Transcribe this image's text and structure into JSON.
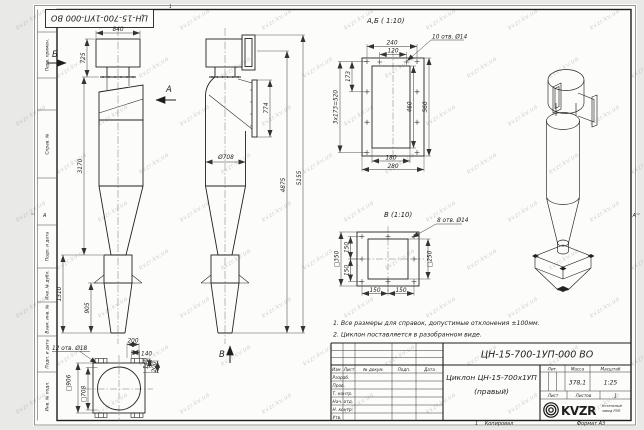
{
  "watermark": {
    "text": "kvzr.kv.ua"
  },
  "frame": {
    "stamp_rotated": "ЦН-15-700-1УП-000 ВО",
    "margin_labels": [
      "Перв. примен.",
      "Справ. №",
      "Подп. и дата",
      "Инв. № дубл.",
      "Взам. инв. №",
      "Подп. и дата",
      "Инв. № подл."
    ],
    "zone_top": "1",
    "zone_left": "А",
    "zone_right": "А",
    "copy_mark": "1",
    "copy_label": "Копировал",
    "format_label": "Формат А3"
  },
  "notes": [
    "1. Все размеры для справок, допустимые отклонения ±100мм.",
    "2. Циклон поставляется в разобранном виде."
  ],
  "views": {
    "front": {
      "label_b": "Б",
      "label_a": "А",
      "dim_840": "840",
      "dim_725": "725",
      "dim_3170": "3170",
      "dim_1310": "1310",
      "dim_905": "905"
    },
    "side": {
      "label_v": "В",
      "dim_774": "774",
      "dim_708": "Ø708",
      "dim_4875": "4875",
      "dim_5155": "5155"
    },
    "section_ab": {
      "title": "А,Б ( 1:10)",
      "callout": "10 отв. Ø14",
      "dim_240": "240",
      "dim_120": "120",
      "dim_173": "173",
      "dim_520": "3х173=520",
      "dim_460": "460",
      "dim_560": "560",
      "dim_180": "180",
      "dim_280": "280"
    },
    "section_v": {
      "title": "В (1:10)",
      "callout": "8 отв. Ø14",
      "dim_350": "□350",
      "dim_250": "□250",
      "dim_150a": "150",
      "dim_150b": "150",
      "dim_150c": "150",
      "dim_150d": "150"
    },
    "bottom": {
      "callout": "12 отв. Ø18",
      "dim_200t": "200",
      "dim_140t": "140",
      "dim_140r": "140",
      "dim_200r": "200",
      "dim_906": "□906",
      "dim_708": "□708"
    }
  },
  "title_block": {
    "designation": "ЦН-15-700-1УП-000 ВО",
    "name_line1": "Циклон ЦН-15-700х1УП",
    "name_line2": "(правый)",
    "cols": {
      "izm": "Изм.",
      "list": "Лист",
      "doc": "№ докум.",
      "podp": "Подп.",
      "data": "Дата"
    },
    "rows": [
      "Разраб.",
      "Пров.",
      "Т. контр.",
      "Нач. отд.",
      "Н. контр.",
      "Утв."
    ],
    "lit": "Лит.",
    "massa": "Масса",
    "masshtab": "Масштаб",
    "massa_value": "378,1",
    "scale_value": "1:25",
    "list_label": "Лист",
    "listov_label": "Листов",
    "listov_value": "1",
    "logo_text": "KVZR",
    "logo_sub1": "Котельный",
    "logo_sub2": "завод РЭП"
  }
}
